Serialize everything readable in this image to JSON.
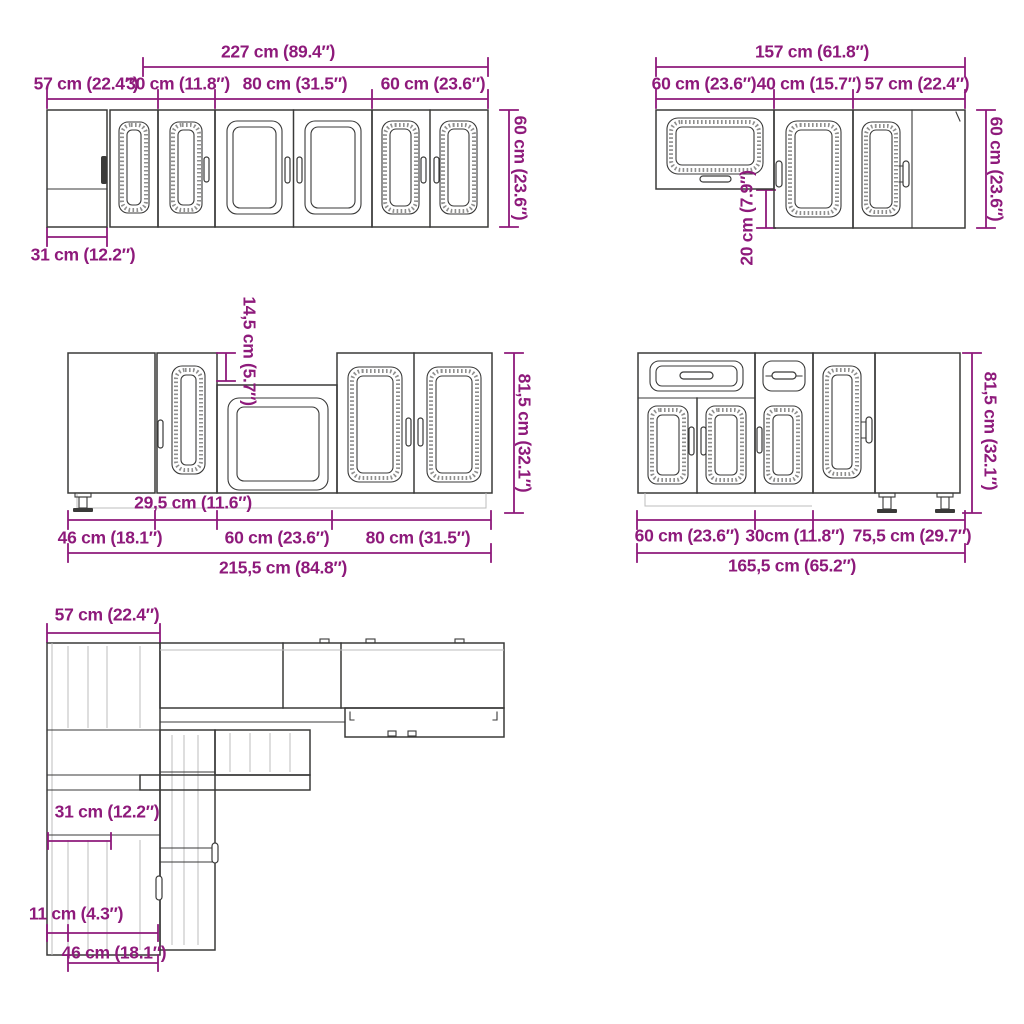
{
  "colors": {
    "dimension_text": "#8e1a7b",
    "drawing_line": "#3a3a39",
    "background": "#ffffff"
  },
  "diagrams": {
    "wall_row": {
      "total": "227 cm (89.4″)",
      "seg1": "57 cm (22.4″)",
      "seg2": "30 cm (11.8″)",
      "seg3": "80 cm (31.5″)",
      "seg4": "60 cm (23.6″)",
      "height": "60 cm (23.6″)",
      "corner_depth": "31 cm (12.2″)"
    },
    "wall_corner": {
      "total": "157 cm (61.8″)",
      "seg1": "60 cm (23.6″)",
      "seg2": "40 cm (15.7″)",
      "seg3": "57 cm (22.4″)",
      "height": "60 cm (23.6″)",
      "drop": "20 cm (7.9″)"
    },
    "base_row": {
      "top_strip": "14,5 cm (5.7″)",
      "height": "81,5 cm (32.1″)",
      "narrow": "29,5 cm (11.6″)",
      "seg1": "46 cm (18.1″)",
      "seg2": "60 cm (23.6″)",
      "seg3": "80 cm (31.5″)",
      "total": "215,5 cm (84.8″)"
    },
    "base_corner": {
      "height": "81,5 cm (32.1″)",
      "seg1": "60 cm (23.6″)",
      "seg2": "30cm (11.8″)",
      "seg3": "75,5 cm (29.7″)",
      "total": "165,5 cm (65.2″)"
    },
    "plan": {
      "top": "57 cm (22.4″)",
      "mid": "31 cm (12.2″)",
      "small": "11 cm (4.3″)",
      "bottom": "46 cm (18.1″)"
    }
  }
}
